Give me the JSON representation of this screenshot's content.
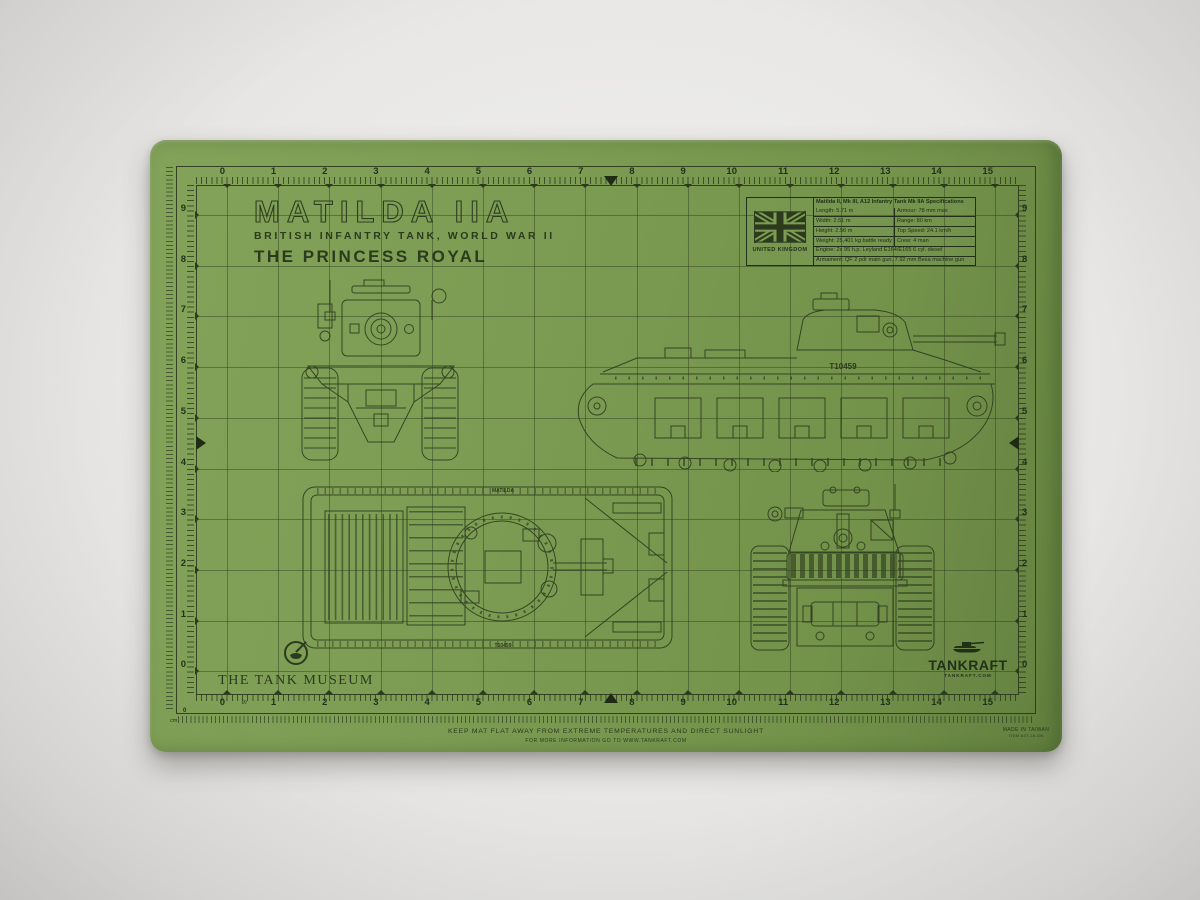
{
  "photo": {
    "background_hex": "#e9e8e6"
  },
  "mat": {
    "surface_hex": "#7c9c53",
    "ink_hex": "#2c3a1d"
  },
  "title": {
    "name": "MATILDA IIA",
    "subtitle": "BRITISH INFANTRY TANK, WORLD WAR II",
    "designation": "THE PRINCESS ROYAL"
  },
  "flag": {
    "country": "UNITED KINGDOM",
    "flag_icon": "union-jack"
  },
  "spec_table": {
    "header": "Matilda II, Mk III, A12 Infantry Tank Mk IIA Specifications",
    "paired_rows": [
      {
        "left": "Length: 5.71 m",
        "right": "Armour: 78 mm max"
      },
      {
        "left": "Width: 2.51 m",
        "right": "Range: 80 km"
      },
      {
        "left": "Height: 2.56 m",
        "right": "Top Speed: 24.1 km/h"
      },
      {
        "left": "Weight: 25,401 kg battle ready",
        "right": "Crew: 4 man"
      }
    ],
    "full_rows": [
      "Engine: 2x 95 h.p. Leyland E164/E165 6 cyl. diesel",
      "Armament: QF 2 pdr main gun, 7.92 mm Besa machine gun"
    ]
  },
  "rulers": {
    "top": [
      "0",
      "1",
      "2",
      "3",
      "4",
      "5",
      "6",
      "7",
      "8",
      "9",
      "10",
      "11",
      "12",
      "13",
      "14",
      "15"
    ],
    "bottom": [
      "0",
      "1",
      "2",
      "3",
      "4",
      "5",
      "6",
      "7",
      "8",
      "9",
      "10",
      "11",
      "12",
      "13",
      "14",
      "15"
    ],
    "left": [
      "9",
      "8",
      "7",
      "6",
      "5",
      "4",
      "3",
      "2",
      "1",
      "0"
    ],
    "right": [
      "9",
      "8",
      "7",
      "6",
      "5",
      "4",
      "3",
      "2",
      "1",
      "0"
    ],
    "bottom_unit_label": "in",
    "outer_scale": {
      "zero_label": "0",
      "unit_label": "cm"
    }
  },
  "markings": {
    "side_hull_serial": "T10459",
    "top_view_name": "MATILDA",
    "top_view_serial": "T10459"
  },
  "logos": {
    "museum_name": "THE TANK MUSEUM",
    "brand_name": "TANKRAFT",
    "brand_site": "TANKRAFT.COM"
  },
  "footer": {
    "care_line": "KEEP MAT FLAT AWAY FROM EXTREME TEMPERATURES AND DIRECT SUNLIGHT",
    "info_line": "FOR MORE INFORMATION GO TO WWW.TANKRAFT.COM",
    "made_in": "MADE IN TAIWAN",
    "item_code": "ITEM A3T-18-GN"
  }
}
